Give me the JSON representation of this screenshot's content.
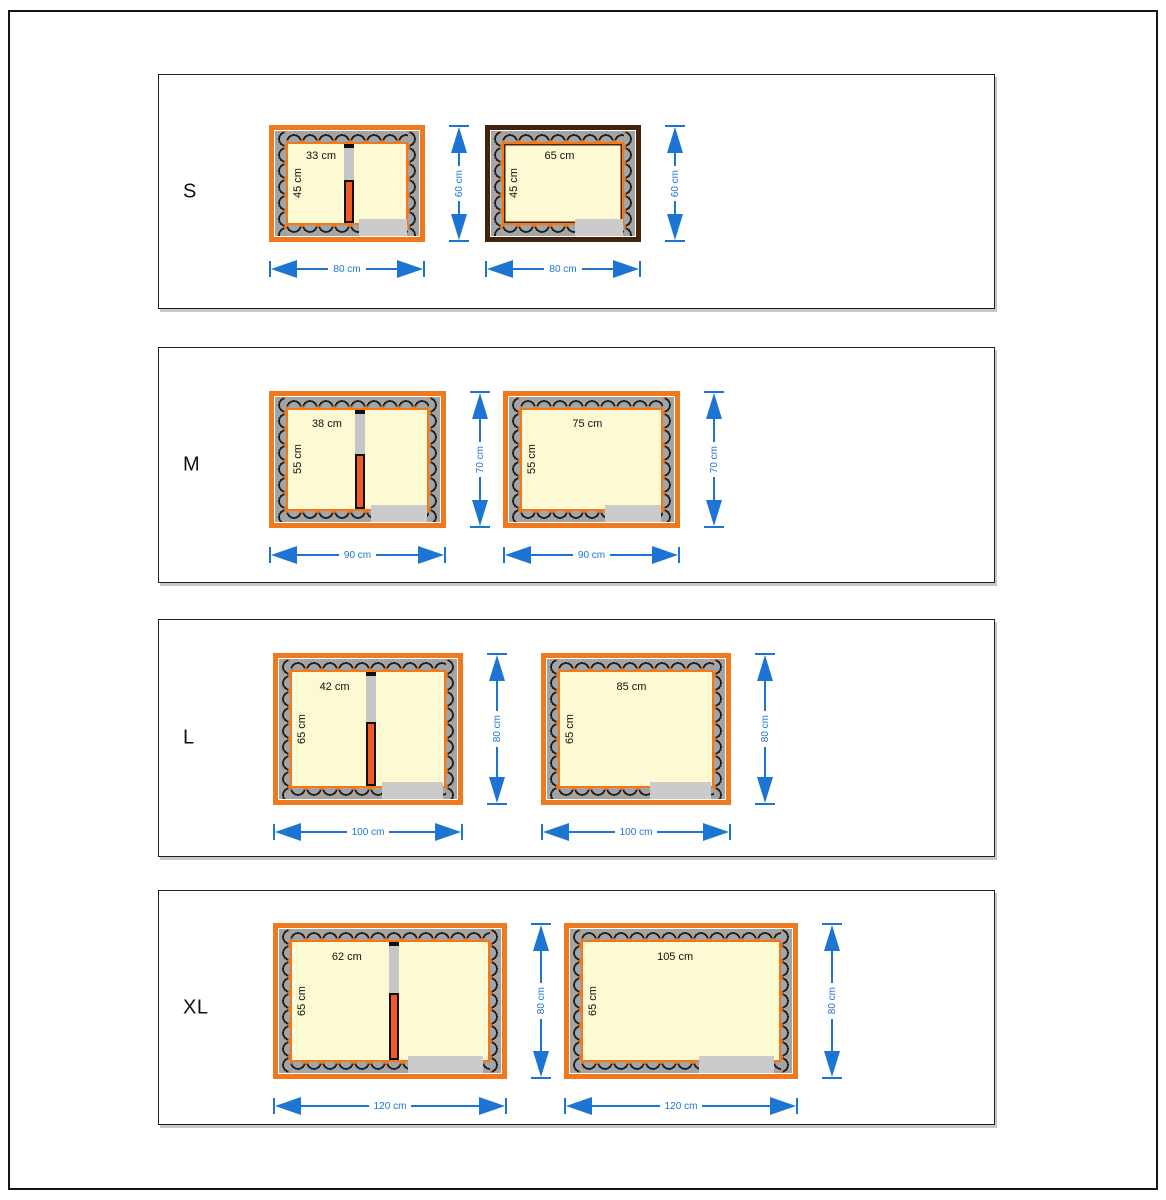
{
  "colors": {
    "frame_orange": "#f0791e",
    "frame_brown": "#45220c",
    "dimension_blue": "#1c75d2",
    "interior_cream": "#fdf9d2",
    "wall_gray": "#a4a4a4",
    "entrance_gray": "#cbcbcb",
    "divider_orange": "#f05a28"
  },
  "panels": [
    {
      "label": "S",
      "plans": [
        {
          "side": "left",
          "width_label": "33 cm",
          "height_label": "45 cm",
          "dim_height": "60 cm",
          "dim_width": "80 cm",
          "frame": "orange",
          "divider": true
        },
        {
          "side": "right",
          "width_label": "65 cm",
          "height_label": "45 cm",
          "dim_height": "60 cm",
          "dim_width": "80 cm",
          "frame": "brown",
          "divider": false
        }
      ]
    },
    {
      "label": "M",
      "plans": [
        {
          "side": "left",
          "width_label": "38 cm",
          "height_label": "55 cm",
          "dim_height": "70 cm",
          "dim_width": "90 cm",
          "frame": "orange",
          "divider": true
        },
        {
          "side": "right",
          "width_label": "75 cm",
          "height_label": "55 cm",
          "dim_height": "70 cm",
          "dim_width": "90 cm",
          "frame": "orange",
          "divider": false
        }
      ]
    },
    {
      "label": "L",
      "plans": [
        {
          "side": "left",
          "width_label": "42 cm",
          "height_label": "65 cm",
          "dim_height": "80 cm",
          "dim_width": "100 cm",
          "frame": "orange",
          "divider": true
        },
        {
          "side": "right",
          "width_label": "85 cm",
          "height_label": "65 cm",
          "dim_height": "80 cm",
          "dim_width": "100 cm",
          "frame": "orange",
          "divider": false
        }
      ]
    },
    {
      "label": "XL",
      "plans": [
        {
          "side": "left",
          "width_label": "62 cm",
          "height_label": "65 cm",
          "dim_height": "80 cm",
          "dim_width": "120 cm",
          "frame": "orange",
          "divider": true
        },
        {
          "side": "right",
          "width_label": "105 cm",
          "height_label": "65 cm",
          "dim_height": "80 cm",
          "dim_width": "120 cm",
          "frame": "orange",
          "divider": false
        }
      ]
    }
  ]
}
